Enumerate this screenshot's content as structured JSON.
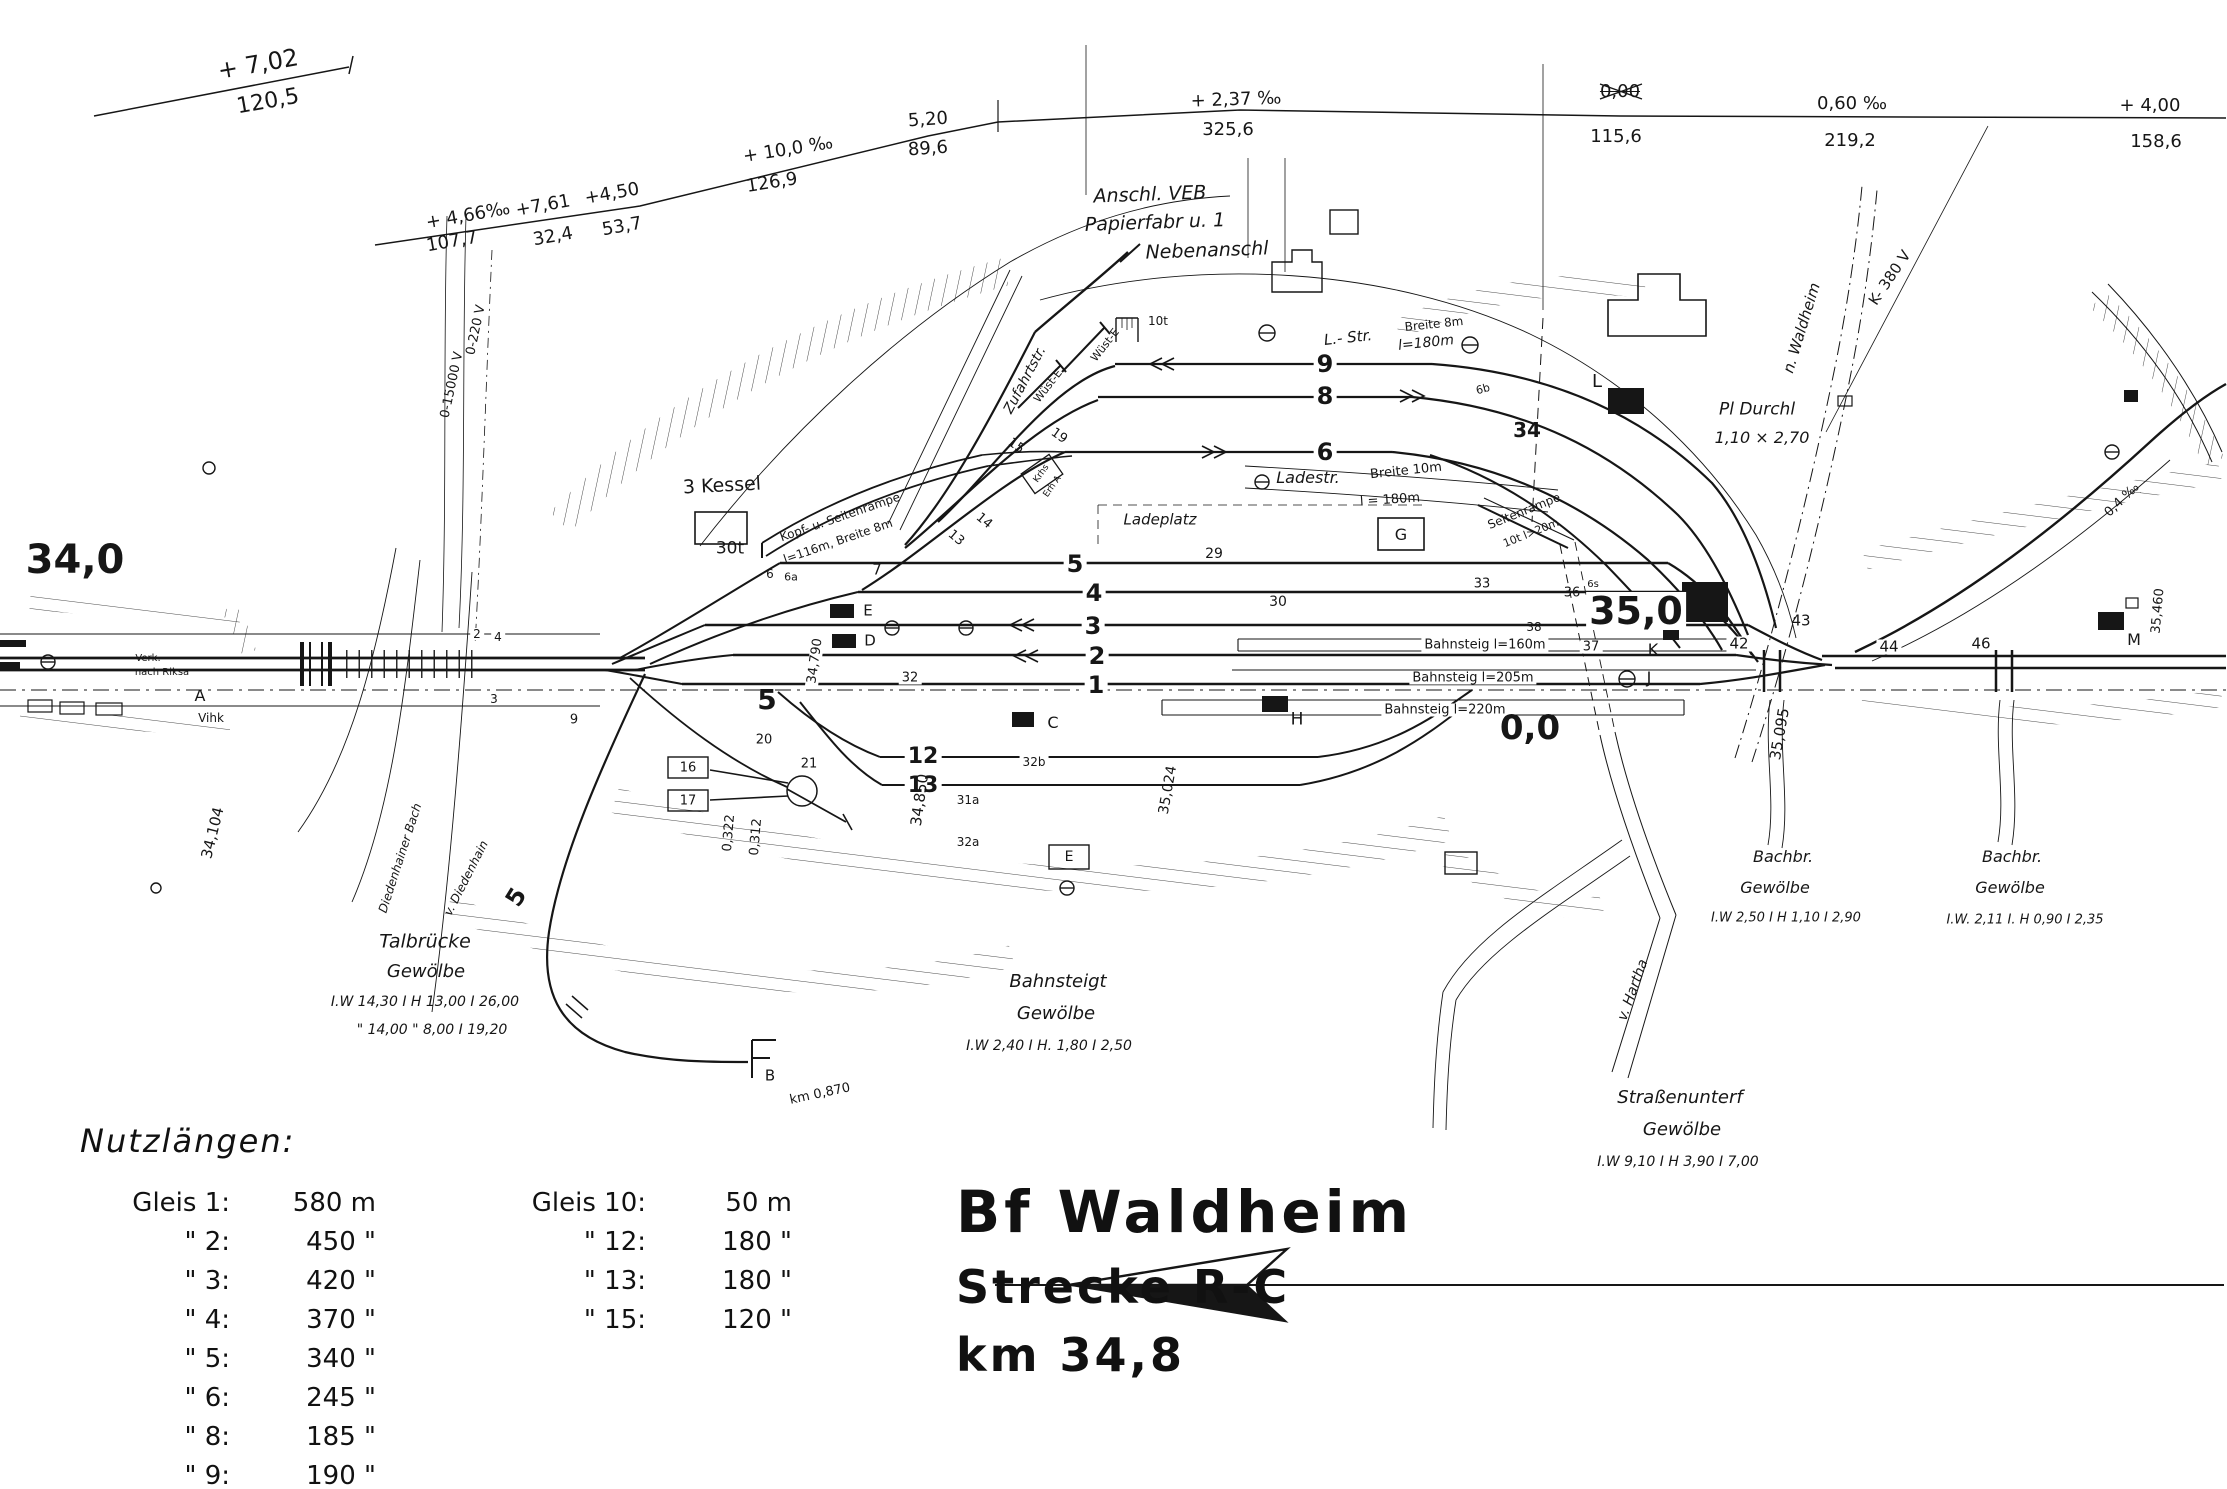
{
  "title_block": {
    "line1": "Bf Waldheim",
    "line2": "Strecke R-C",
    "line3": "km 34,8"
  },
  "nutzlaengen": {
    "heading": "Nutzlängen:",
    "left": [
      [
        "Gleis 1:",
        "580 m"
      ],
      [
        "\" 2:",
        "450 \""
      ],
      [
        "\" 3:",
        "420 \""
      ],
      [
        "\" 4:",
        "370 \""
      ],
      [
        "\" 5:",
        "340 \""
      ],
      [
        "\" 6:",
        "245 \""
      ],
      [
        "\" 8:",
        "185 \""
      ],
      [
        "\" 9:",
        "190 \""
      ]
    ],
    "right": [
      [
        "Gleis 10:",
        "50 m"
      ],
      [
        "\" 12:",
        "180 \""
      ],
      [
        "\" 13:",
        "180 \""
      ],
      [
        "\" 15:",
        "120 \""
      ]
    ]
  },
  "colors": {
    "ink": "#161616",
    "paper": "#ffffff"
  },
  "labels": [
    {
      "t": "+ 7,02",
      "x": 258,
      "y": 64,
      "s": 24,
      "r": -10
    },
    {
      "t": "120,5",
      "x": 268,
      "y": 102,
      "s": 22,
      "r": -10
    },
    {
      "t": "+ 4,66‰",
      "x": 468,
      "y": 216,
      "s": 18,
      "r": -10
    },
    {
      "t": "+7,61",
      "x": 543,
      "y": 206,
      "s": 18,
      "r": -10
    },
    {
      "t": "+4,50",
      "x": 612,
      "y": 194,
      "s": 18,
      "r": -10
    },
    {
      "t": "107,7",
      "x": 452,
      "y": 242,
      "s": 18,
      "r": -10
    },
    {
      "t": "32,4",
      "x": 553,
      "y": 237,
      "s": 18,
      "r": -10
    },
    {
      "t": "53,7",
      "x": 622,
      "y": 227,
      "s": 18,
      "r": -10
    },
    {
      "t": "+ 10,0 ‰",
      "x": 788,
      "y": 150,
      "s": 18,
      "r": -9
    },
    {
      "t": "126,9",
      "x": 772,
      "y": 183,
      "s": 18,
      "r": -9
    },
    {
      "t": "5,20",
      "x": 928,
      "y": 120,
      "s": 18,
      "r": -4
    },
    {
      "t": "89,6",
      "x": 928,
      "y": 149,
      "s": 18,
      "r": -4
    },
    {
      "t": "+ 2,37 ‰",
      "x": 1236,
      "y": 100,
      "s": 18,
      "r": -2
    },
    {
      "t": "325,6",
      "x": 1228,
      "y": 130,
      "s": 18
    },
    {
      "t": "0,00",
      "x": 1620,
      "y": 92,
      "s": 18,
      "k": "strike"
    },
    {
      "t": "115,6",
      "x": 1616,
      "y": 137,
      "s": 18
    },
    {
      "t": "0,60 ‰",
      "x": 1852,
      "y": 104,
      "s": 18
    },
    {
      "t": "219,2",
      "x": 1850,
      "y": 141,
      "s": 18
    },
    {
      "t": "+ 4,00",
      "x": 2150,
      "y": 106,
      "s": 18
    },
    {
      "t": "158,6",
      "x": 2156,
      "y": 142,
      "s": 18
    },
    {
      "t": "Anschl. VEB",
      "x": 1150,
      "y": 195,
      "s": 19,
      "r": -2,
      "k": "i"
    },
    {
      "t": "Papierfabr u. 1",
      "x": 1155,
      "y": 223,
      "s": 19,
      "r": -2,
      "k": "i"
    },
    {
      "t": "Nebenanschl",
      "x": 1207,
      "y": 251,
      "s": 19,
      "r": -2,
      "k": "i"
    },
    {
      "t": "Zufahrtstr.",
      "x": 1025,
      "y": 380,
      "s": 14,
      "r": -62,
      "k": "i"
    },
    {
      "t": "Wüst-E",
      "x": 1105,
      "y": 345,
      "s": 11,
      "r": -52
    },
    {
      "t": "Wüst-E",
      "x": 1048,
      "y": 386,
      "s": 11,
      "r": -52
    },
    {
      "t": "3 Kessel",
      "x": 722,
      "y": 486,
      "s": 19,
      "r": -3
    },
    {
      "t": "30t",
      "x": 730,
      "y": 549,
      "s": 17
    },
    {
      "t": "Kopf- u. Seitenrampe",
      "x": 840,
      "y": 517,
      "s": 12,
      "r": -19
    },
    {
      "t": "l=116m, Breite 8m",
      "x": 838,
      "y": 541,
      "s": 12,
      "r": -19
    },
    {
      "t": "13",
      "x": 956,
      "y": 538,
      "s": 13,
      "r": 40
    },
    {
      "t": "14",
      "x": 984,
      "y": 521,
      "s": 13,
      "r": 40
    },
    {
      "t": "15",
      "x": 1016,
      "y": 446,
      "s": 13,
      "r": 35
    },
    {
      "t": "19",
      "x": 1059,
      "y": 436,
      "s": 13,
      "r": 35
    },
    {
      "t": "Krhs",
      "x": 1042,
      "y": 474,
      "s": 9,
      "r": -55
    },
    {
      "t": "Erh A",
      "x": 1053,
      "y": 487,
      "s": 9,
      "r": -55
    },
    {
      "t": "10t",
      "x": 1158,
      "y": 321,
      "s": 12
    },
    {
      "t": "L.- Str.",
      "x": 1348,
      "y": 338,
      "s": 15,
      "r": -6,
      "k": "i"
    },
    {
      "t": "l=180m",
      "x": 1426,
      "y": 343,
      "s": 14,
      "r": -6,
      "k": "i"
    },
    {
      "t": "Breite 8m",
      "x": 1434,
      "y": 324,
      "s": 12,
      "r": -6
    },
    {
      "t": "9",
      "x": 1325,
      "y": 364,
      "s": 24,
      "k": "b bg"
    },
    {
      "t": "8",
      "x": 1325,
      "y": 396,
      "s": 24,
      "k": "b bg"
    },
    {
      "t": "6",
      "x": 1325,
      "y": 452,
      "s": 24,
      "k": "b bg"
    },
    {
      "t": "34",
      "x": 1527,
      "y": 430,
      "s": 20,
      "k": "b"
    },
    {
      "t": "6b",
      "x": 1483,
      "y": 389,
      "s": 11,
      "r": -15
    },
    {
      "t": "Ladestr.",
      "x": 1308,
      "y": 478,
      "s": 16,
      "k": "i"
    },
    {
      "t": "Breite 10m",
      "x": 1406,
      "y": 471,
      "s": 13,
      "r": -6
    },
    {
      "t": "l = 180m",
      "x": 1390,
      "y": 500,
      "s": 13,
      "r": -4
    },
    {
      "t": "Ladeplatz",
      "x": 1160,
      "y": 520,
      "s": 15,
      "k": "i"
    },
    {
      "t": "G",
      "x": 1401,
      "y": 535,
      "s": 16
    },
    {
      "t": "Seitenrampe",
      "x": 1524,
      "y": 511,
      "s": 12,
      "r": -22
    },
    {
      "t": "10t  l>20m",
      "x": 1531,
      "y": 533,
      "s": 11,
      "r": -22
    },
    {
      "t": "29",
      "x": 1214,
      "y": 554,
      "s": 14
    },
    {
      "t": "30",
      "x": 1278,
      "y": 602,
      "s": 14
    },
    {
      "t": "5",
      "x": 1075,
      "y": 564,
      "s": 24,
      "k": "b bg"
    },
    {
      "t": "4",
      "x": 1094,
      "y": 593,
      "s": 24,
      "k": "b bg"
    },
    {
      "t": "3",
      "x": 1093,
      "y": 626,
      "s": 24,
      "k": "b bg"
    },
    {
      "t": "2",
      "x": 1097,
      "y": 656,
      "s": 24,
      "k": "b bg"
    },
    {
      "t": "1",
      "x": 1096,
      "y": 685,
      "s": 24,
      "k": "b bg"
    },
    {
      "t": "7",
      "x": 877,
      "y": 570,
      "s": 15
    },
    {
      "t": "6",
      "x": 770,
      "y": 574,
      "s": 12
    },
    {
      "t": "6a",
      "x": 791,
      "y": 577,
      "s": 11
    },
    {
      "t": "E",
      "x": 868,
      "y": 611,
      "s": 15
    },
    {
      "t": "D",
      "x": 870,
      "y": 641,
      "s": 15
    },
    {
      "t": "2",
      "x": 477,
      "y": 634,
      "s": 12,
      "k": "bg"
    },
    {
      "t": "4",
      "x": 498,
      "y": 637,
      "s": 12,
      "k": "bg"
    },
    {
      "t": "3",
      "x": 494,
      "y": 699,
      "s": 12,
      "k": "bg"
    },
    {
      "t": "9",
      "x": 574,
      "y": 720,
      "s": 13
    },
    {
      "t": "5",
      "x": 767,
      "y": 700,
      "s": 28,
      "k": "b"
    },
    {
      "t": "32",
      "x": 910,
      "y": 678,
      "s": 13,
      "k": "bg"
    },
    {
      "t": "12",
      "x": 923,
      "y": 757,
      "s": 22,
      "k": "b bg"
    },
    {
      "t": "13",
      "x": 923,
      "y": 786,
      "s": 22,
      "k": "b bg"
    },
    {
      "t": "32b",
      "x": 1034,
      "y": 762,
      "s": 12,
      "k": "bg"
    },
    {
      "t": "31a",
      "x": 968,
      "y": 800,
      "s": 12
    },
    {
      "t": "32a",
      "x": 968,
      "y": 842,
      "s": 12
    },
    {
      "t": "21",
      "x": 809,
      "y": 764,
      "s": 13
    },
    {
      "t": "20",
      "x": 764,
      "y": 740,
      "s": 13
    },
    {
      "t": "16",
      "x": 688,
      "y": 768,
      "s": 13
    },
    {
      "t": "17",
      "x": 688,
      "y": 801,
      "s": 13
    },
    {
      "t": "C",
      "x": 1053,
      "y": 723,
      "s": 16
    },
    {
      "t": "Bahnsteig l=160m",
      "x": 1485,
      "y": 645,
      "s": 13,
      "k": "bg"
    },
    {
      "t": "Bahnsteig l=205m",
      "x": 1473,
      "y": 678,
      "s": 13,
      "k": "bg"
    },
    {
      "t": "Bahnsteig l=220m",
      "x": 1445,
      "y": 710,
      "s": 13,
      "k": "bg"
    },
    {
      "t": "33",
      "x": 1482,
      "y": 584,
      "s": 13
    },
    {
      "t": "36",
      "x": 1572,
      "y": 593,
      "s": 13
    },
    {
      "t": "6s",
      "x": 1593,
      "y": 585,
      "s": 10
    },
    {
      "t": "38",
      "x": 1534,
      "y": 627,
      "s": 12
    },
    {
      "t": "37",
      "x": 1591,
      "y": 647,
      "s": 13,
      "k": "bg"
    },
    {
      "t": "35,0",
      "x": 1636,
      "y": 611,
      "s": 38,
      "k": "b bg"
    },
    {
      "t": "0,0",
      "x": 1530,
      "y": 728,
      "s": 34,
      "k": "b"
    },
    {
      "t": "K",
      "x": 1653,
      "y": 650,
      "s": 16
    },
    {
      "t": "J",
      "x": 1649,
      "y": 678,
      "s": 16
    },
    {
      "t": "42",
      "x": 1739,
      "y": 644,
      "s": 15,
      "k": "bg"
    },
    {
      "t": "43",
      "x": 1801,
      "y": 621,
      "s": 15
    },
    {
      "t": "44",
      "x": 1889,
      "y": 647,
      "s": 15,
      "k": "bg"
    },
    {
      "t": "46",
      "x": 1981,
      "y": 644,
      "s": 15,
      "k": "bg"
    },
    {
      "t": "H",
      "x": 1297,
      "y": 720,
      "s": 17
    },
    {
      "t": "M",
      "x": 2134,
      "y": 640,
      "s": 16
    },
    {
      "t": "L",
      "x": 1597,
      "y": 382,
      "s": 18
    },
    {
      "t": "Pl Durchl",
      "x": 1757,
      "y": 410,
      "s": 17,
      "k": "i"
    },
    {
      "t": "1,10 × 2,70",
      "x": 1762,
      "y": 438,
      "s": 16,
      "k": "i"
    },
    {
      "t": "n. Waldheim",
      "x": 1802,
      "y": 328,
      "s": 15,
      "r": -73,
      "k": "i"
    },
    {
      "t": "K- 380 V",
      "x": 1890,
      "y": 278,
      "s": 15,
      "r": -56
    },
    {
      "t": "0,4 ‰",
      "x": 2122,
      "y": 500,
      "s": 13,
      "r": -44
    },
    {
      "t": "35,460",
      "x": 2158,
      "y": 611,
      "s": 13,
      "r": -85
    },
    {
      "t": "34,790",
      "x": 815,
      "y": 661,
      "s": 13,
      "r": -82,
      "k": "bg"
    },
    {
      "t": "34,850",
      "x": 920,
      "y": 800,
      "s": 15,
      "r": -82
    },
    {
      "t": "0,322",
      "x": 729,
      "y": 833,
      "s": 13,
      "r": -85
    },
    {
      "t": "0,312",
      "x": 756,
      "y": 837,
      "s": 13,
      "r": -85
    },
    {
      "t": "35,024",
      "x": 1168,
      "y": 790,
      "s": 14,
      "r": -80
    },
    {
      "t": "35,095",
      "x": 1780,
      "y": 734,
      "s": 15,
      "r": -80
    },
    {
      "t": "34,104",
      "x": 213,
      "y": 833,
      "s": 15,
      "r": -76
    },
    {
      "t": "34,0",
      "x": 75,
      "y": 560,
      "s": 40,
      "k": "b"
    },
    {
      "t": "Verk.",
      "x": 148,
      "y": 659,
      "s": 10
    },
    {
      "t": "nach Riksa",
      "x": 162,
      "y": 673,
      "s": 10
    },
    {
      "t": "A",
      "x": 200,
      "y": 696,
      "s": 16
    },
    {
      "t": "Vihk",
      "x": 211,
      "y": 718,
      "s": 12
    },
    {
      "t": "0-15000 V",
      "x": 452,
      "y": 385,
      "s": 13,
      "r": -78
    },
    {
      "t": "0-220 V",
      "x": 476,
      "y": 330,
      "s": 13,
      "r": -78
    },
    {
      "t": "Diedenhainer Bach",
      "x": 400,
      "y": 858,
      "s": 12,
      "r": -72,
      "k": "i"
    },
    {
      "t": "v. Diedenhain",
      "x": 466,
      "y": 878,
      "s": 12,
      "r": -63,
      "k": "i"
    },
    {
      "t": "Talbrücke",
      "x": 425,
      "y": 942,
      "s": 19,
      "k": "i"
    },
    {
      "t": "Gewölbe",
      "x": 426,
      "y": 972,
      "s": 18,
      "k": "i"
    },
    {
      "t": "I.W 14,30 I H 13,00 I 26,00",
      "x": 425,
      "y": 1002,
      "s": 14,
      "k": "i"
    },
    {
      "t": "\" 14,00   \" 8,00 I 19,20",
      "x": 432,
      "y": 1030,
      "s": 14,
      "k": "i"
    },
    {
      "t": "5",
      "x": 516,
      "y": 897,
      "s": 24,
      "r": -58,
      "k": "b"
    },
    {
      "t": "B",
      "x": 770,
      "y": 1076,
      "s": 15
    },
    {
      "t": "km 0,870",
      "x": 820,
      "y": 1094,
      "s": 13,
      "r": -12
    },
    {
      "t": "E",
      "x": 1069,
      "y": 857,
      "s": 14
    },
    {
      "t": "Bahnsteigt",
      "x": 1058,
      "y": 982,
      "s": 18,
      "k": "i"
    },
    {
      "t": "Gewölbe",
      "x": 1056,
      "y": 1014,
      "s": 18,
      "k": "i"
    },
    {
      "t": "I.W 2,40 I H. 1,80 I 2,50",
      "x": 1049,
      "y": 1046,
      "s": 14,
      "k": "i"
    },
    {
      "t": "v. Hartha",
      "x": 1633,
      "y": 990,
      "s": 14,
      "r": -70,
      "k": "i"
    },
    {
      "t": "Straßenunterf",
      "x": 1680,
      "y": 1098,
      "s": 18,
      "k": "i"
    },
    {
      "t": "Gewölbe",
      "x": 1682,
      "y": 1130,
      "s": 18,
      "k": "i"
    },
    {
      "t": "I.W 9,10 I H 3,90 I 7,00",
      "x": 1678,
      "y": 1162,
      "s": 14,
      "k": "i"
    },
    {
      "t": "Bachbr.",
      "x": 1783,
      "y": 857,
      "s": 16,
      "k": "i"
    },
    {
      "t": "Gewölbe",
      "x": 1775,
      "y": 888,
      "s": 16,
      "k": "i"
    },
    {
      "t": "I.W 2,50 I H 1,10 I 2,90",
      "x": 1786,
      "y": 918,
      "s": 13,
      "k": "i"
    },
    {
      "t": "Bachbr.",
      "x": 2012,
      "y": 857,
      "s": 16,
      "k": "i"
    },
    {
      "t": "Gewölbe",
      "x": 2010,
      "y": 888,
      "s": 16,
      "k": "i"
    },
    {
      "t": "I.W. 2,11 I. H 0,90 I 2,35",
      "x": 2025,
      "y": 920,
      "s": 13,
      "k": "i"
    }
  ]
}
